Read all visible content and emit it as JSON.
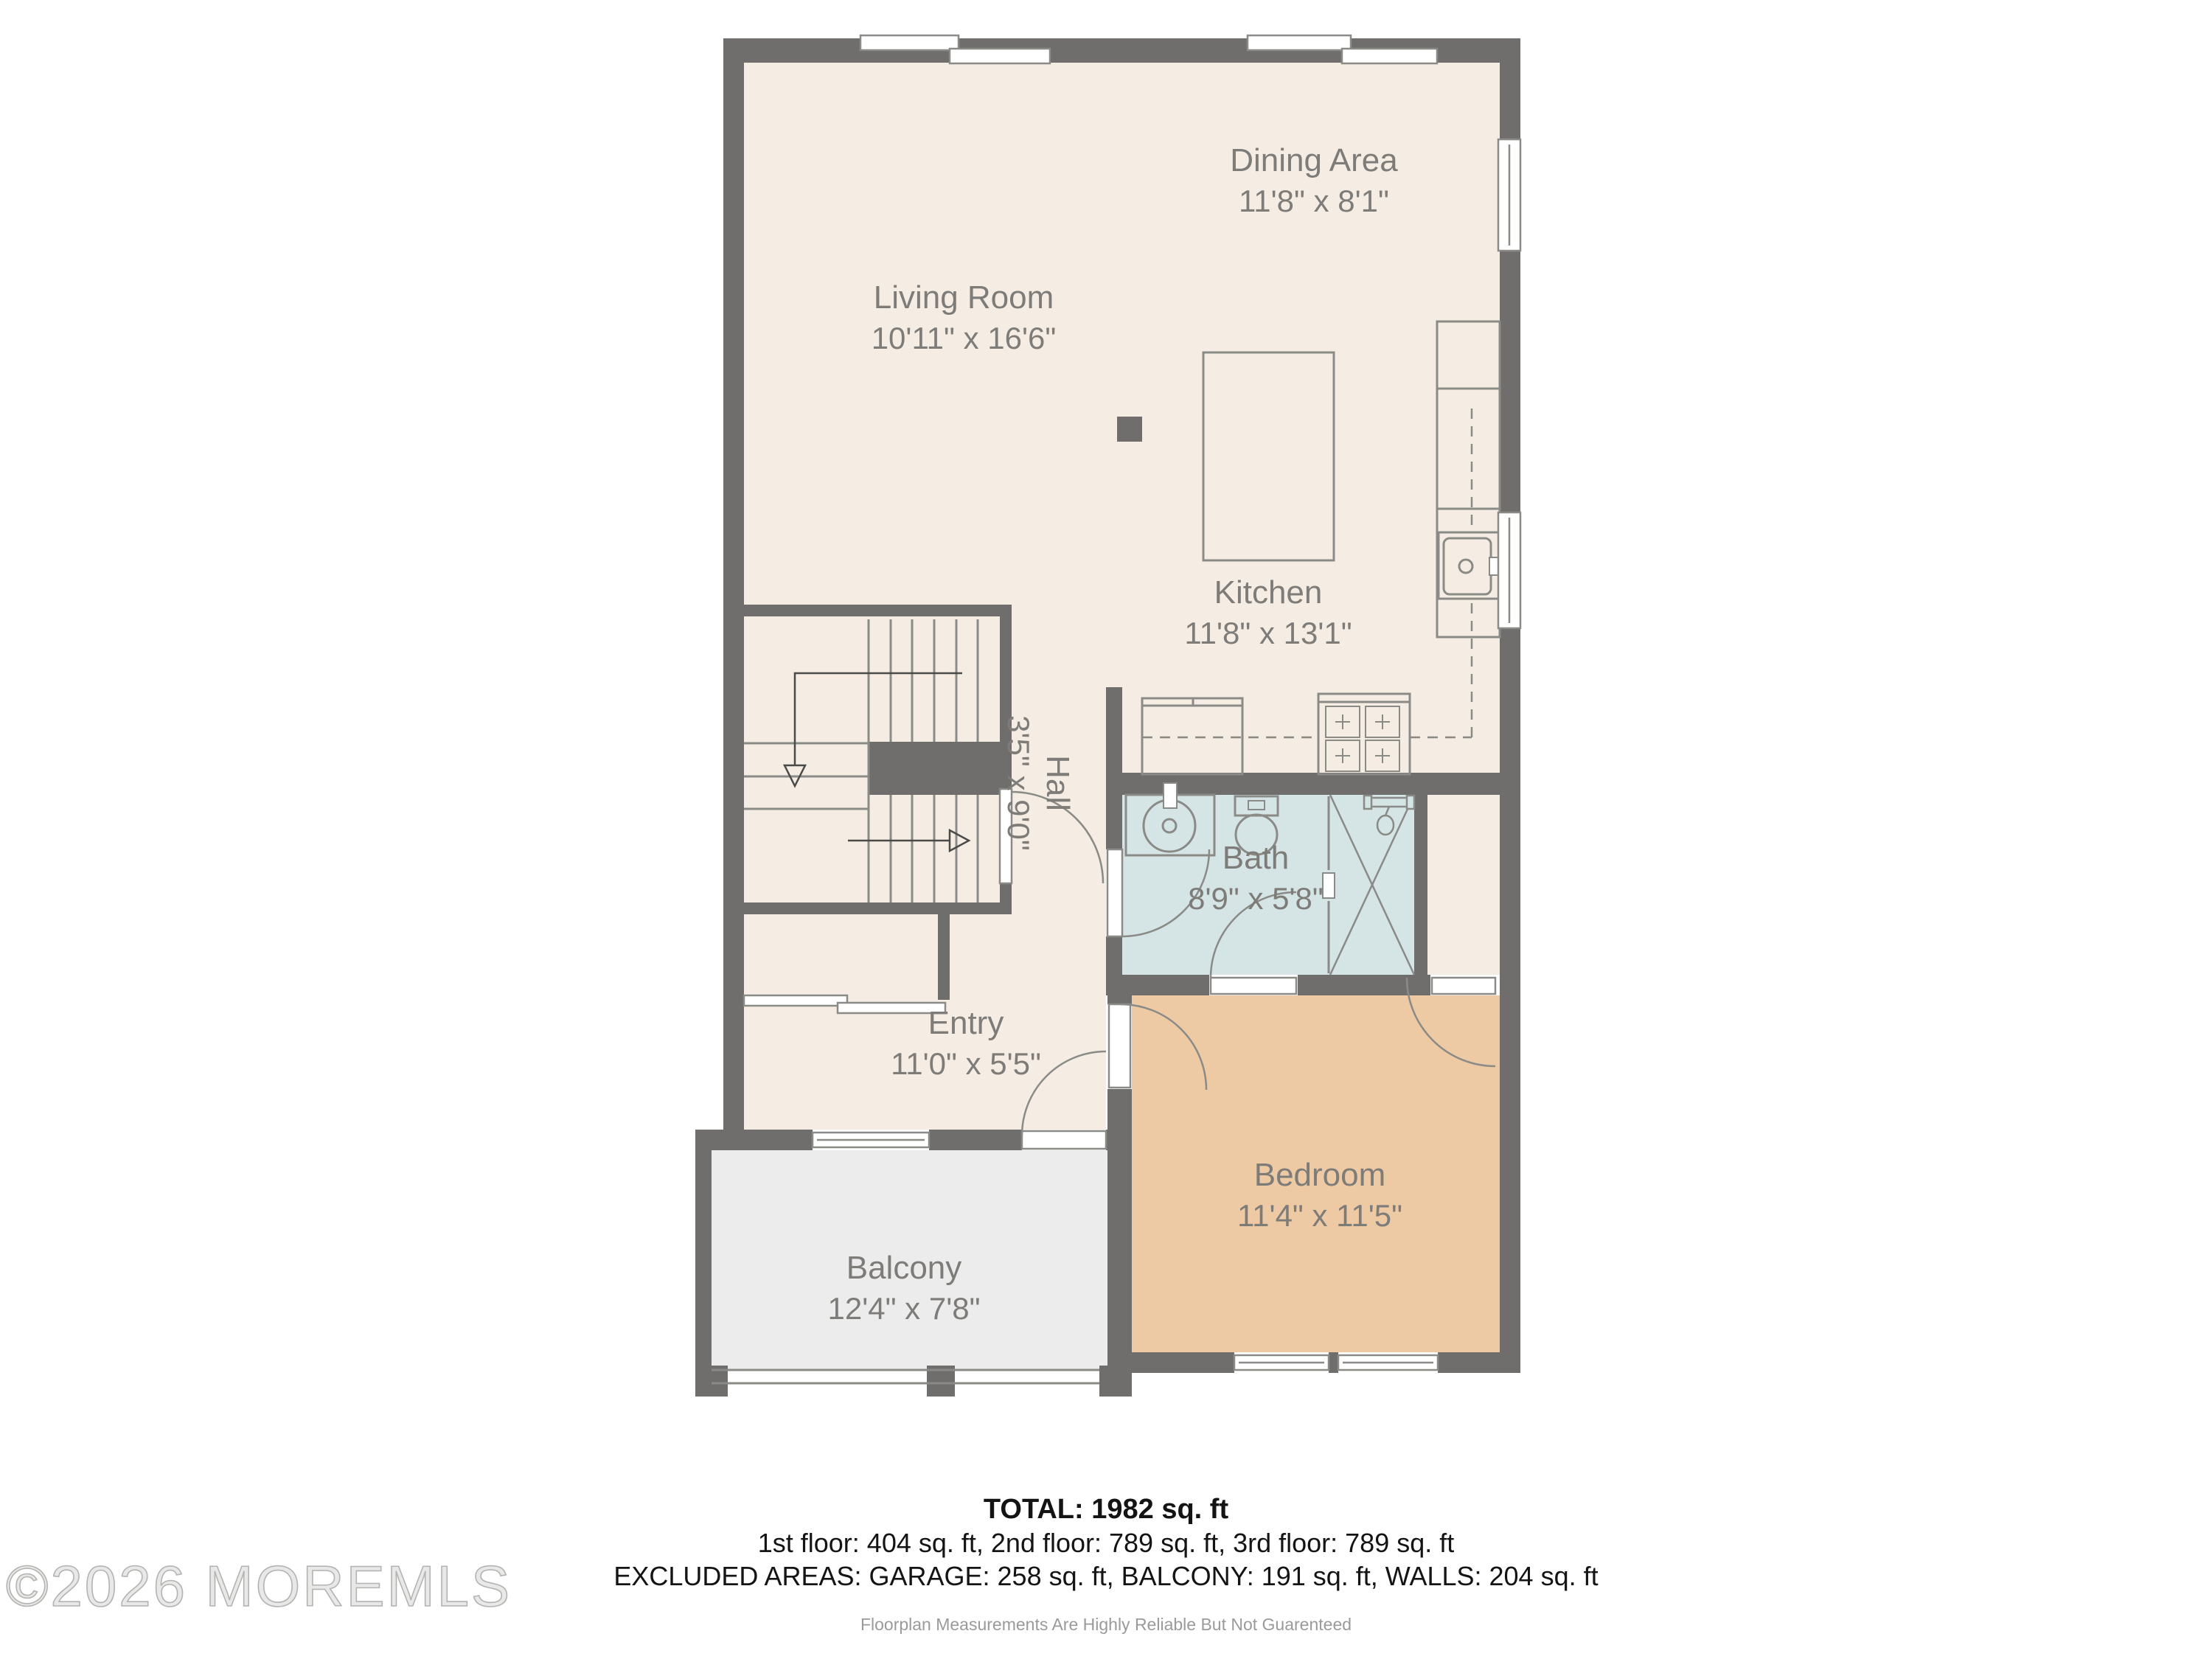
{
  "watermark": "©2026 MOREMLS",
  "colors": {
    "wall": "#6f6e6c",
    "floor_main": "#f5ede4",
    "floor_bath": "#d5e4e5",
    "floor_bedroom": "#eecaa4",
    "floor_balcony": "#ececec",
    "line": "#8a8a87",
    "label_text": "#7e7c79",
    "summary_text": "#141414",
    "disclaimer_text": "#9a9a9a"
  },
  "rooms": [
    {
      "id": "living",
      "name": "Living Room",
      "dims": "10'11\" x 16'6\""
    },
    {
      "id": "dining",
      "name": "Dining Area",
      "dims": "11'8\" x 8'1\""
    },
    {
      "id": "kitchen",
      "name": "Kitchen",
      "dims": "11'8\" x 13'1\""
    },
    {
      "id": "hall",
      "name": "Hall",
      "dims": "3'5\" x 9'0\""
    },
    {
      "id": "bath",
      "name": "Bath",
      "dims": "8'9\" x 5'8\""
    },
    {
      "id": "entry",
      "name": "Entry",
      "dims": "11'0\" x 5'5\""
    },
    {
      "id": "bedroom",
      "name": "Bedroom",
      "dims": "11'4\" x 11'5\""
    },
    {
      "id": "balcony",
      "name": "Balcony",
      "dims": "12'4\" x 7'8\""
    }
  ],
  "summary": {
    "total": "TOTAL: 1982 sq. ft",
    "floors": "1st floor: 404 sq. ft, 2nd floor: 789 sq. ft, 3rd floor: 789 sq. ft",
    "excluded": "EXCLUDED AREAS: GARAGE: 258 sq. ft, BALCONY: 191 sq. ft, WALLS: 204 sq. ft",
    "disclaimer": "Floorplan Measurements Are Highly Reliable But Not Guarenteed"
  }
}
